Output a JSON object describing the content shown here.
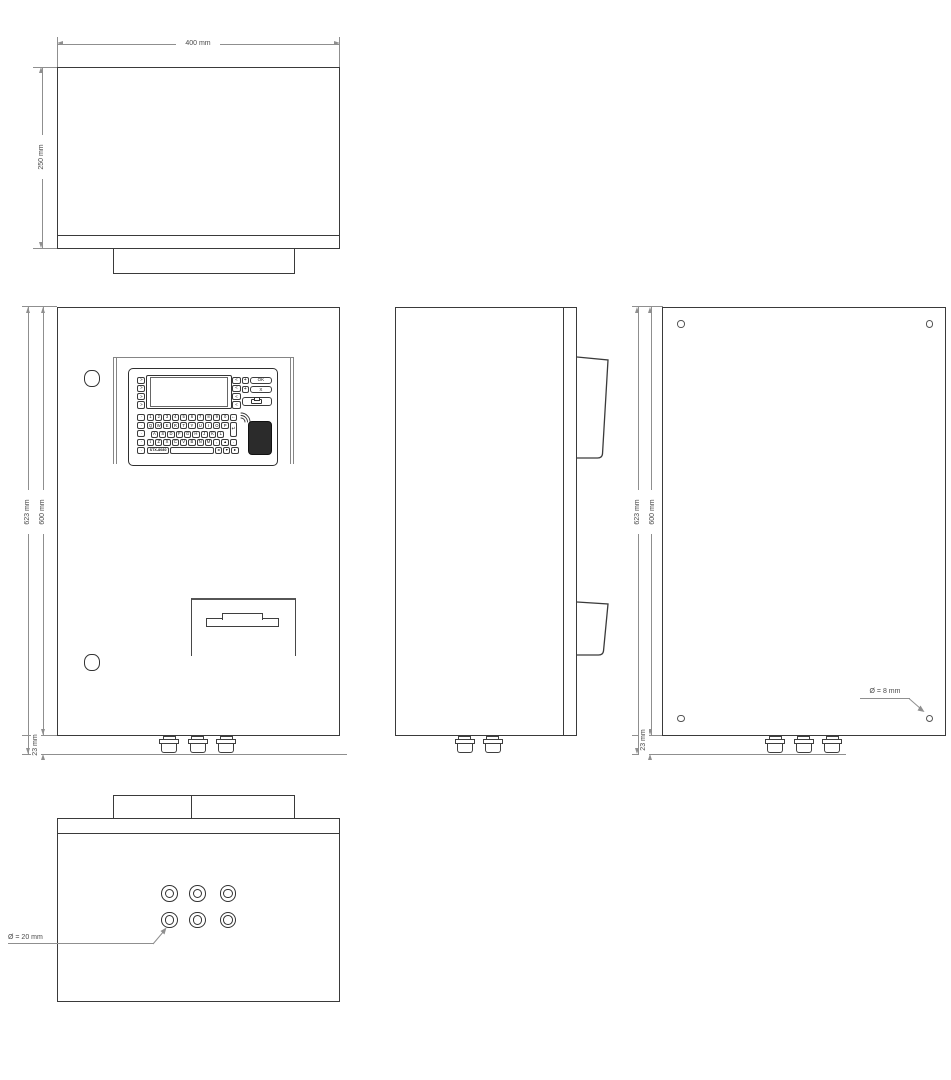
{
  "colors": {
    "outline": "#3a3a3a",
    "dimension_lines": "#8f8f8f",
    "dimension_text": "#4a4a4a",
    "rfid_pad": "#2b2b2b"
  },
  "dimensions": {
    "top_width": "400 mm",
    "top_depth": "250 mm",
    "front_height_total": "623 mm",
    "front_height_body": "600 mm",
    "front_glands_height": "23 mm",
    "back_height_total": "623 mm",
    "back_height_body": "600 mm",
    "back_glands_height": "23 mm",
    "back_hole_diameter": "Ø = 8 mm",
    "bottom_gland_diameter": "Ø = 20 mm"
  },
  "keypad": {
    "model": "STX-8080",
    "ok": "OK",
    "cancel": "X",
    "plus_top": "+",
    "plus_bottom": "+",
    "enter": "↵",
    "screen_left_keys": [
      ">",
      ">",
      ">",
      ">"
    ],
    "screen_right_keys": [
      "<",
      "<",
      "<",
      "<"
    ],
    "function_column": [
      "·",
      "·",
      "·",
      "·",
      "·"
    ],
    "number_row": [
      "1",
      "2",
      "3",
      "4",
      "5",
      "6",
      "7",
      "8",
      "9",
      "0",
      "←"
    ],
    "qwerty_row": [
      "Q",
      "W",
      "E",
      "R",
      "T",
      "Y",
      "U",
      "I",
      "O",
      "P"
    ],
    "home_row": [
      "A",
      "S",
      "D",
      "F",
      "G",
      "H",
      "J",
      "K",
      "L"
    ],
    "bottom_row": [
      "⇧",
      "Z",
      "X",
      "C",
      "V",
      "B",
      "N",
      "M",
      ",",
      "▲",
      "."
    ],
    "nav_row": [
      "◄",
      "▼",
      "►"
    ]
  }
}
